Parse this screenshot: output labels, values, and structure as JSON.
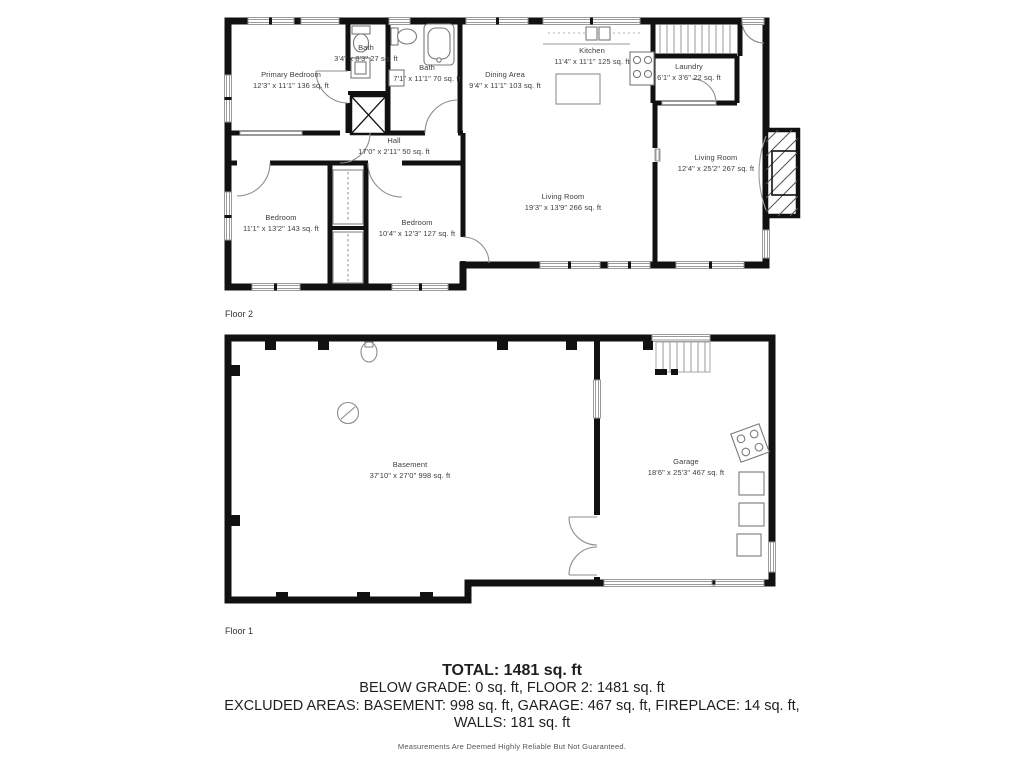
{
  "floor2": {
    "label": "Floor 2",
    "rooms": {
      "primary_bedroom": {
        "name": "Primary Bedroom",
        "dims": "12'3\" x 11'1\" 136 sq. ft"
      },
      "bath_small": {
        "name": "Bath",
        "dims": "3'4\" x 8'3\" 27 sq. ft"
      },
      "bath_large": {
        "name": "Bath",
        "dims": "7'1\" x 11'1\" 70 sq. ft"
      },
      "dining_area": {
        "name": "Dining Area",
        "dims": "9'4\" x 11'1\" 103 sq. ft"
      },
      "kitchen": {
        "name": "Kitchen",
        "dims": "11'4\" x 11'1\" 125 sq. ft"
      },
      "laundry": {
        "name": "Laundry",
        "dims": "6'1\" x 3'6\" 22 sq. ft"
      },
      "living_room_right": {
        "name": "Living Room",
        "dims": "12'4\" x 25'2\" 267 sq. ft"
      },
      "hall": {
        "name": "Hall",
        "dims": "17'0\" x 2'11\" 50 sq. ft"
      },
      "living_room_center": {
        "name": "Living Room",
        "dims": "19'3\" x 13'9\" 266 sq. ft"
      },
      "bedroom_left": {
        "name": "Bedroom",
        "dims": "11'1\" x 13'2\" 143 sq. ft"
      },
      "bedroom_right": {
        "name": "Bedroom",
        "dims": "10'4\" x 12'3\" 127 sq. ft"
      }
    }
  },
  "floor1": {
    "label": "Floor 1",
    "rooms": {
      "basement": {
        "name": "Basement",
        "dims": "37'10\" x 27'0\" 998 sq. ft"
      },
      "garage": {
        "name": "Garage",
        "dims": "18'6\" x 25'3\" 467 sq. ft"
      }
    }
  },
  "summary": {
    "total": "TOTAL: 1481 sq. ft",
    "line1": "BELOW GRADE: 0 sq. ft, FLOOR 2: 1481 sq. ft",
    "line2": "EXCLUDED AREAS: BASEMENT: 998 sq. ft, GARAGE: 467 sq. ft, FIREPLACE: 14 sq. ft,",
    "line3": "WALLS: 181 sq. ft",
    "disclaimer": "Measurements Are Deemed Highly Reliable But Not Guaranteed."
  },
  "colors": {
    "walls": "#111111",
    "window": "#9a9a9a",
    "fixture": "#7a7a7a"
  }
}
